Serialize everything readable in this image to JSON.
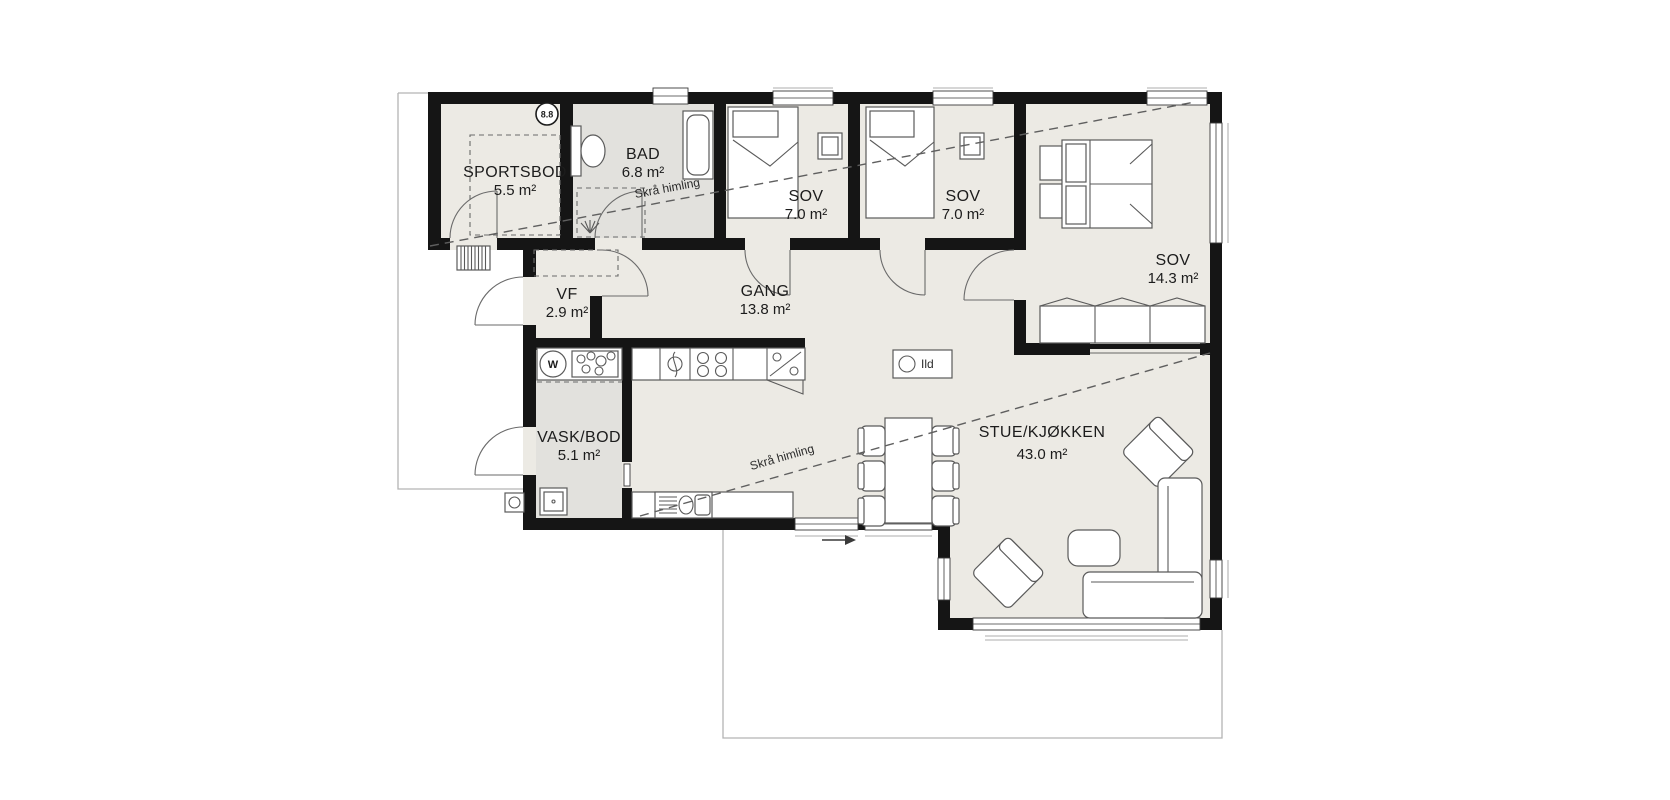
{
  "plan": {
    "background": "#ffffff",
    "floor_color": "#ECEAE4",
    "wet_room_color": "#E2E1DD",
    "wall_color": "#151515",
    "rooms": {
      "sportsbod": {
        "name": "SPORTSBOD",
        "area": "5.5 m²"
      },
      "bad": {
        "name": "BAD",
        "area": "6.8 m²"
      },
      "sov1": {
        "name": "SOV",
        "area": "7.0 m²"
      },
      "sov2": {
        "name": "SOV",
        "area": "7.0 m²"
      },
      "sov3": {
        "name": "SOV",
        "area": "14.3 m²"
      },
      "vf": {
        "name": "VF",
        "area": "2.9 m²"
      },
      "gang": {
        "name": "GANG",
        "area": "13.8 m²"
      },
      "vask_bod": {
        "name": "VASK/BOD",
        "area": "5.1 m²"
      },
      "stue_kjokken": {
        "name": "STUE/KJØKKEN",
        "area": "43.0 m²"
      }
    },
    "annotations": {
      "sloped_ceiling_1": "Skrå himling",
      "sloped_ceiling_2": "Skrå himling",
      "fireplace": "Ild",
      "badge": "8.8",
      "washer": "W"
    }
  }
}
